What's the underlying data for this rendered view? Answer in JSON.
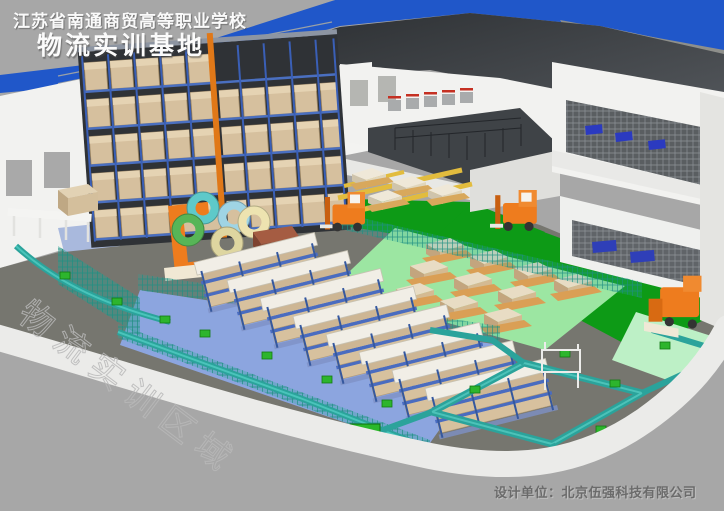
{
  "banner": {
    "school_name": "江苏省南通商贸高等职业学校",
    "title": "物流实训基地"
  },
  "footer": {
    "credit": "设计单位：北京伍强科技有限公司"
  },
  "watermark": {
    "text": "物流实训区域"
  },
  "colors": {
    "background": "#a7a7a7",
    "roof_blue": "#2057c9",
    "ceiling_dark": "#33363a",
    "wall_white": "#f2f2f0",
    "floor_gray": "#76766f",
    "floor_green": "#0d9a16",
    "floor_mint": "#bdf0c6",
    "floor_light_green": "#9ce6a2",
    "floor_blue": "#8ca5df",
    "rack_blue": "#3c62b8",
    "carton_tan": "#d6c09e",
    "conveyor_teal": "#2ba39b",
    "machine_orange": "#ee7c1e",
    "stripe_yellow": "#e2bc3e",
    "apron_white": "#ebebe9",
    "credit_text": "#6b6b6b",
    "title_text": "#fafafa"
  }
}
